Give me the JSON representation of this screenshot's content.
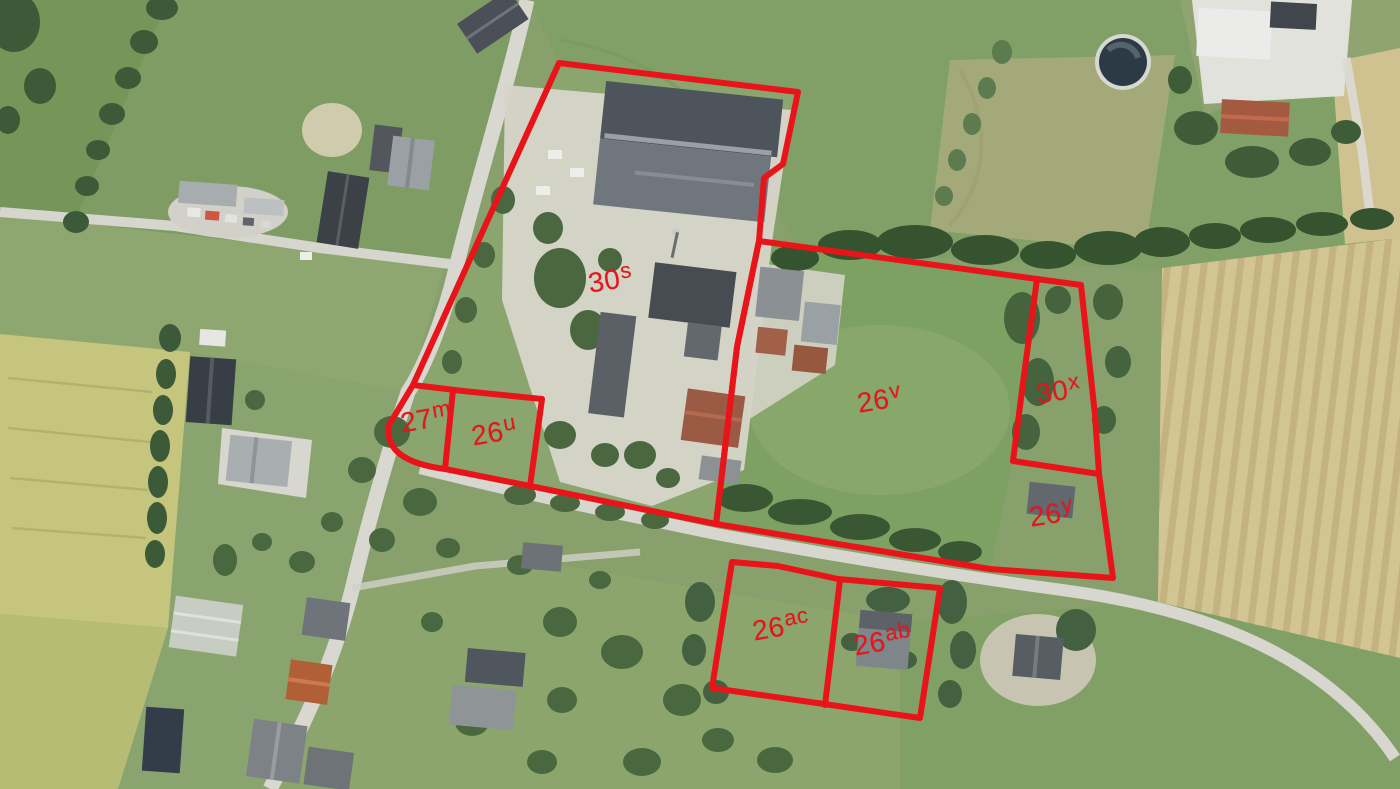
{
  "map": {
    "kind": "aerial-photo-with-cadastral-overlay",
    "overlay_color": "#e8141a",
    "stroke_width": 6,
    "parcels": [
      {
        "id": "30s",
        "base": "30",
        "sup": "s",
        "x": 586,
        "y": 268,
        "rot": -9
      },
      {
        "id": "26v",
        "base": "26",
        "sup": "v",
        "x": 855,
        "y": 388,
        "rot": -9
      },
      {
        "id": "30x",
        "base": "30",
        "sup": "x",
        "x": 1034,
        "y": 379,
        "rot": -9
      },
      {
        "id": "26y",
        "base": "26",
        "sup": "y",
        "x": 1027,
        "y": 502,
        "rot": -9
      },
      {
        "id": "27m",
        "base": "27",
        "sup": "m",
        "x": 398,
        "y": 408,
        "rot": -10
      },
      {
        "id": "26u",
        "base": "26",
        "sup": "u",
        "x": 469,
        "y": 421,
        "rot": -10
      },
      {
        "id": "26ac",
        "base": "26",
        "sup": "ac",
        "x": 750,
        "y": 616,
        "rot": -10
      },
      {
        "id": "26ab",
        "base": "26",
        "sup": "ab",
        "x": 851,
        "y": 631,
        "rot": -10
      }
    ],
    "boundaries": [
      {
        "name": "parcel-30s-outline",
        "d": "M 559,63 L 798,92 L 783,164 L 764,178 L 759,241 L 737,347 L 716,524 L 530,486 L 445,469 Q 383,461 389,425 L 413,385 Z"
      },
      {
        "name": "line-27m-26u-top",
        "d": "M 413,385 L 463,391 L 542,399"
      },
      {
        "name": "line-27m-26u-divider",
        "d": "M 453,390 L 445,469"
      },
      {
        "name": "line-26u-east",
        "d": "M 542,399 L 530,486"
      },
      {
        "name": "parcel-26v-30x-26y-outline",
        "d": "M 759,241 L 1037,279 L 1081,285 L 1095,415 L 1099,474 L 1113,578 L 990,569 L 716,524 L 737,347 Z"
      },
      {
        "name": "line-30x-west",
        "d": "M 1037,279 L 1024,375 L 1013,461"
      },
      {
        "name": "line-26y-north",
        "d": "M 1013,461 L 1099,474"
      },
      {
        "name": "parcel-26ac-26ab-outline",
        "d": "M 732,562 L 778,566 L 838,579 L 940,588 L 920,718 L 824,704 L 712,688 Z"
      },
      {
        "name": "line-26ac-26ab-divider",
        "d": "M 840,580 L 825,705"
      }
    ]
  }
}
